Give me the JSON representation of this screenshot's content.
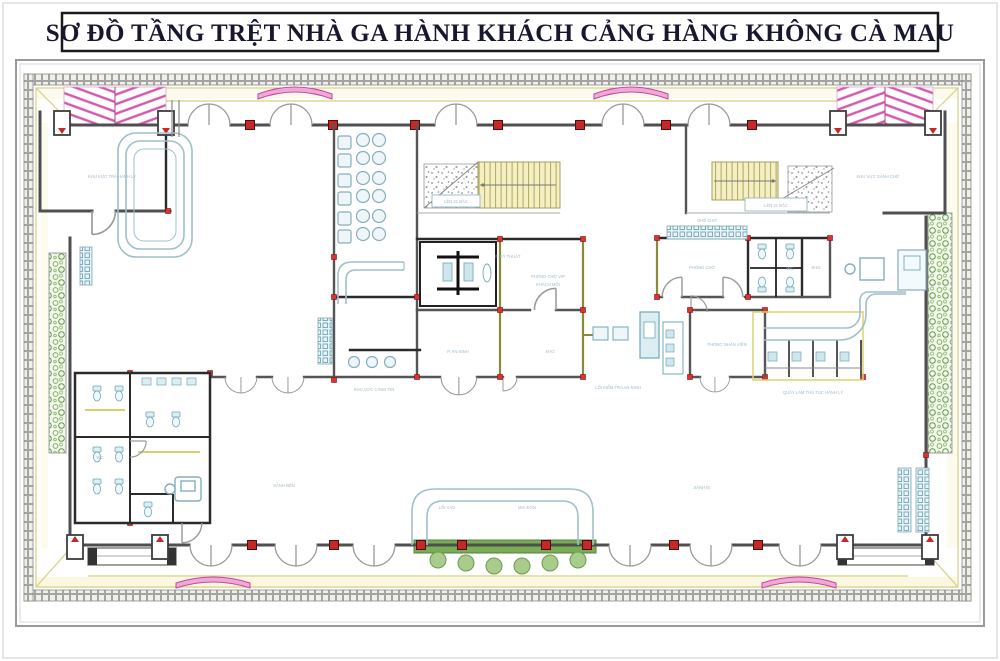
{
  "title": "SƠ ĐỒ TẦNG TRỆT NHÀ GA HÀNH KHÁCH CẢNG HÀNG KHÔNG CÀ MAU",
  "colors": {
    "wall_gray": "#4f4f4f",
    "column_red": "#c62828",
    "furniture_blue": "#86aebc",
    "landscape_green": "#7fb25a",
    "canopy_pink": "#d557ae",
    "site_line_yellow": "#d9d470"
  },
  "plan": {
    "labels": [
      {
        "text": "KHU VỰC TRẢ HÀNH LÝ"
      },
      {
        "text": "SẢNH ĐẾN"
      },
      {
        "text": "SẢNH ĐI"
      },
      {
        "text": "KHU VỰC SẢNH CHỜ"
      },
      {
        "text": "LÊN 21 BẬC"
      },
      {
        "text": "LÊN 21 BẬC"
      },
      {
        "text": "P. KỸ THUẬT"
      },
      {
        "text": "PHÒNG CHỜ VIP"
      },
      {
        "text": "KHÁCH MỜI"
      },
      {
        "text": "P. AN NINH"
      },
      {
        "text": "KHO"
      },
      {
        "text": "LỐI KIỂM TRA AN NINH"
      },
      {
        "text": "PHÒNG CHỜ"
      },
      {
        "text": "KHO"
      },
      {
        "text": "PHÒNG NHÂN VIÊN"
      },
      {
        "text": "QUẦY LÀM THỦ TỤC HÀNH LÝ"
      },
      {
        "text": "GHẾ CHỜ"
      },
      {
        "text": "LỐI VÀO"
      },
      {
        "text": "MÁI ĐÓN"
      },
      {
        "text": "WC"
      },
      {
        "text": "WC"
      },
      {
        "text": "KHU VỰC CĂNG TIN"
      }
    ]
  }
}
